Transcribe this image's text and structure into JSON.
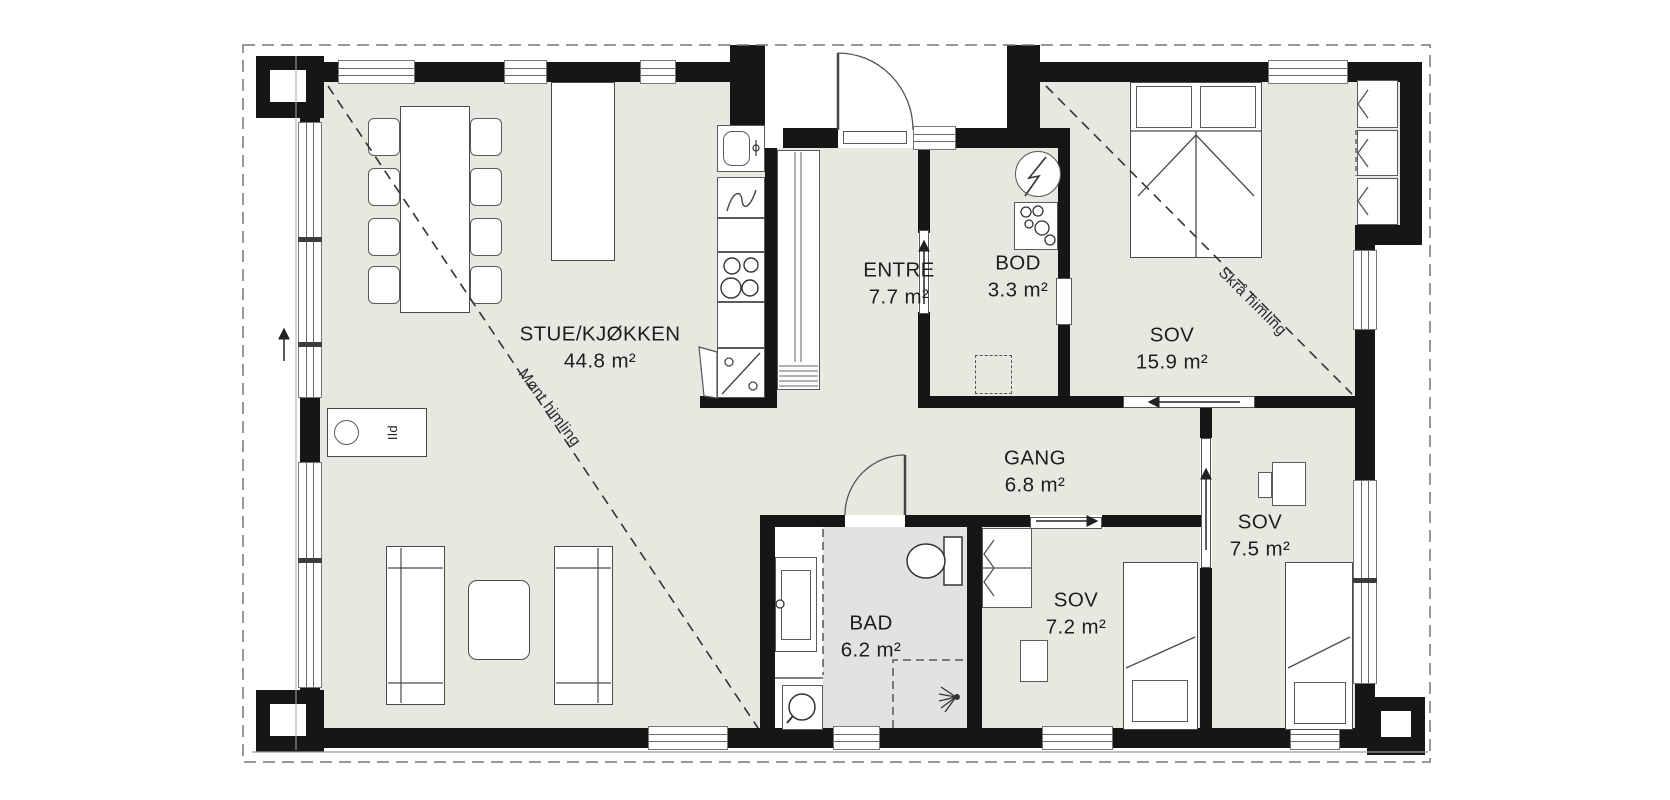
{
  "plan": {
    "rooms": [
      {
        "name": "STUE/KJØKKEN",
        "area": "44.8 m²"
      },
      {
        "name": "ENTRE",
        "area": "7.7 m²"
      },
      {
        "name": "BOD",
        "area": "3.3 m²"
      },
      {
        "name": "SOV",
        "area": "15.9 m²"
      },
      {
        "name": "GANG",
        "area": "6.8 m²"
      },
      {
        "name": "BAD",
        "area": "6.2 m²"
      },
      {
        "name": "SOV",
        "area": "7.2 m²"
      },
      {
        "name": "SOV",
        "area": "7.5 m²"
      }
    ],
    "annotations": {
      "ridge_ceiling": "Mønt himling",
      "sloped_ceiling": "Skrå himling",
      "fireplace": "Ild"
    },
    "colors": {
      "floor": "#e9e8e0",
      "bathroom_floor": "#e2e2e1",
      "wall": "#161616",
      "background": "#ffffff"
    }
  }
}
